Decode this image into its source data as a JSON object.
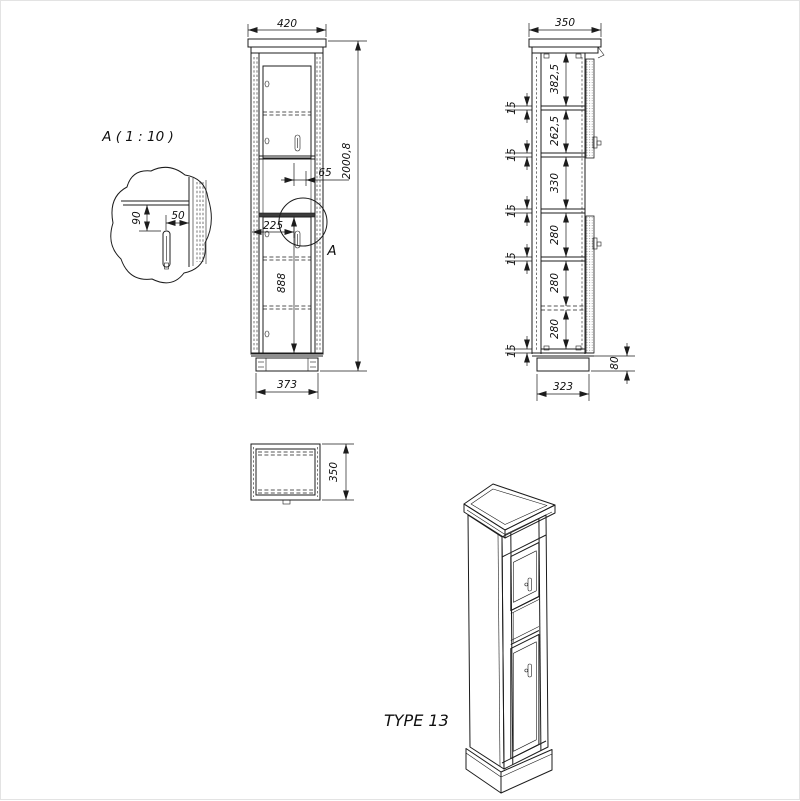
{
  "front_view": {
    "width_top": "420",
    "height_overall": "2000,8",
    "handle_to_door_edge": "65",
    "handle_from_side": "225",
    "lower_section_height": "888",
    "base_width": "373",
    "detail_ref": "A"
  },
  "side_view": {
    "depth_top": "350",
    "base_depth": "323",
    "plinth_height": "80",
    "shelf_thickness": [
      "15",
      "15",
      "15",
      "15",
      "15"
    ],
    "sections": [
      "382,5",
      "262,5",
      "330",
      "280",
      "280",
      "280"
    ]
  },
  "top_view": {
    "depth": "350"
  },
  "detail_view": {
    "title": "A ( 1 : 10 )",
    "dim_vertical": "90",
    "dim_horizontal": "50"
  },
  "footer": {
    "type_label": "TYPE 13"
  }
}
